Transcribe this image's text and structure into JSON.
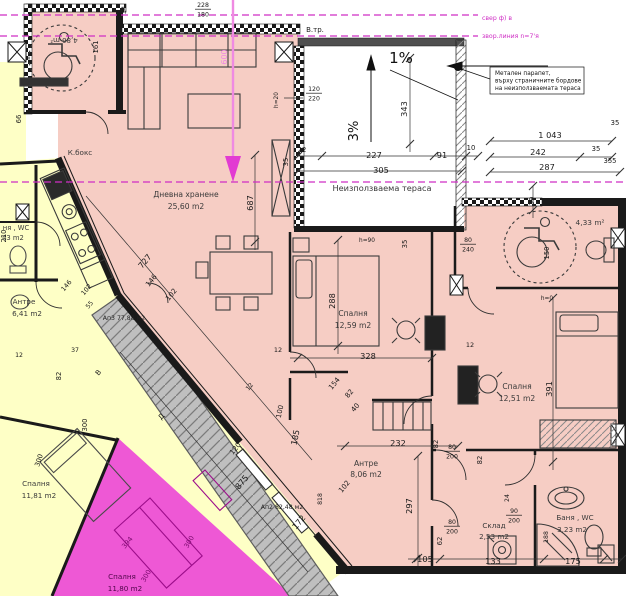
{
  "canvas": {
    "w": 626,
    "h": 596
  },
  "colors": {
    "apartment_fill": "#f6cdc4",
    "neighbor_fill": "#feffc6",
    "magenta_apartment_fill": "#ee58d5",
    "stair_fill": "#bfbfbf",
    "wall": "#1a1a1a",
    "terrace_fill": "#ffffff",
    "annotation_magenta": "#cf2ec4"
  },
  "labels": [
    {
      "n": "room-label-kbox",
      "t": "К.бокс",
      "x": 80,
      "y": 155,
      "s": 7.2,
      "c": "#3a3a3a"
    },
    {
      "n": "room-label-living",
      "t": "Дневна хранене",
      "x": 186,
      "y": 197,
      "s": 7.6,
      "c": "#3a3a3a"
    },
    {
      "n": "room-area-living",
      "t": "25,60 m2",
      "x": 186,
      "y": 209,
      "s": 7.6,
      "c": "#3a3a3a"
    },
    {
      "n": "room-label-terrace",
      "t": "Неизползваема тераса",
      "x": 382,
      "y": 191,
      "s": 8.2,
      "c": "#3a3a3a"
    },
    {
      "n": "room-label-bedroom1",
      "t": "Спалня",
      "x": 353,
      "y": 316,
      "s": 7.6,
      "c": "#3a3a3a"
    },
    {
      "n": "room-area-bedroom1",
      "t": "12,59 m2",
      "x": 353,
      "y": 328,
      "s": 7.6,
      "c": "#3a3a3a"
    },
    {
      "n": "room-label-bedroom2",
      "t": "Спалня",
      "x": 517,
      "y": 389,
      "s": 7.6,
      "c": "#3a3a3a"
    },
    {
      "n": "room-area-bedroom2",
      "t": "12,51 m2",
      "x": 517,
      "y": 401,
      "s": 7.6,
      "c": "#3a3a3a"
    },
    {
      "n": "room-label-hall",
      "t": "Антре",
      "x": 366,
      "y": 466,
      "s": 7.6,
      "c": "#3a3a3a"
    },
    {
      "n": "room-area-hall",
      "t": "8,06 m2",
      "x": 366,
      "y": 477,
      "s": 7.6,
      "c": "#3a3a3a"
    },
    {
      "n": "room-label-storage",
      "t": "Склад",
      "x": 494,
      "y": 528,
      "s": 7.2,
      "c": "#3a3a3a"
    },
    {
      "n": "room-area-storage",
      "t": "2,53 m2",
      "x": 494,
      "y": 539,
      "s": 7.2,
      "c": "#3a3a3a"
    },
    {
      "n": "room-label-bath",
      "t": "Баня , WC",
      "x": 575,
      "y": 520,
      "s": 7.2,
      "c": "#3a3a3a"
    },
    {
      "n": "room-area-bath",
      "t": "3,23 m2",
      "x": 572,
      "y": 532,
      "s": 7.2,
      "c": "#3a3a3a"
    },
    {
      "n": "room-area-bath2",
      "t": "4,33 m²",
      "x": 590,
      "y": 225,
      "s": 7.4,
      "c": "#3a3a3a"
    },
    {
      "n": "room-area-bath1",
      "t": "4,86 m²",
      "x": 64,
      "y": 38,
      "r": 180,
      "s": 7,
      "c": "#3a3a3a"
    },
    {
      "n": "room-label-hall-left",
      "t": "Антре",
      "x": 24,
      "y": 304,
      "s": 7.2,
      "c": "#3a3a3a"
    },
    {
      "n": "room-area-hall-left",
      "t": "6,41 m2",
      "x": 27,
      "y": 316,
      "s": 7.2,
      "c": "#3a3a3a"
    },
    {
      "n": "room-label-wc-left",
      "t": "ня , WC",
      "x": 16,
      "y": 230,
      "s": 6.8,
      "c": "#3a3a3a"
    },
    {
      "n": "room-area-wc-left",
      "t": "43 m2",
      "x": 13,
      "y": 240,
      "s": 6.8,
      "c": "#3a3a3a"
    },
    {
      "n": "room-label-bedroom-left",
      "t": "Спалня",
      "x": 36,
      "y": 486,
      "s": 7.2,
      "c": "#3a3a3a"
    },
    {
      "n": "room-area-bedroom-left",
      "t": "11,81 m2",
      "x": 39,
      "y": 498,
      "s": 7.2,
      "c": "#3a3a3a"
    },
    {
      "n": "room-label-bedroom-magenta",
      "t": "Спалня",
      "x": 122,
      "y": 579,
      "s": 7.2,
      "c": "#50064a"
    },
    {
      "n": "room-area-bedroom-magenta",
      "t": "11,80 m2",
      "x": 125,
      "y": 591,
      "s": 7.2,
      "c": "#50064a"
    },
    {
      "n": "apartment-label-ap3",
      "t": "Ап3 77,88 м2",
      "x": 124,
      "y": 320,
      "s": 6.2,
      "c": "#222222"
    },
    {
      "n": "apartment-label-ap2",
      "t": "Ап2 82,48 м2",
      "x": 282,
      "y": 509,
      "s": 6.2,
      "c": "#222222"
    },
    {
      "n": "label-vtr",
      "t": "В.тр.",
      "x": 315,
      "y": 32,
      "s": 7,
      "c": "#222222"
    },
    {
      "n": "note-line-1",
      "t": "Метален парапет,",
      "x": 495,
      "y": 75,
      "s": 5.8,
      "c": "#111111",
      "a": "start"
    },
    {
      "n": "note-line-2",
      "t": "върху страничните бордове",
      "x": 495,
      "y": 82.5,
      "s": 5.8,
      "c": "#111111",
      "a": "start"
    },
    {
      "n": "note-line-3",
      "t": "на неизползваемата тераса",
      "x": 495,
      "y": 90,
      "s": 5.8,
      "c": "#111111",
      "a": "start"
    },
    {
      "n": "survey-label-1",
      "t": "свер ф) в",
      "x": 482,
      "y": 20,
      "s": 6.2,
      "c": "#cf2ec4",
      "a": "start"
    },
    {
      "n": "survey-label-2",
      "t": "звор.линия n=7'я",
      "x": 482,
      "y": 38,
      "s": 6.2,
      "c": "#cf2ec4",
      "a": "start"
    },
    {
      "n": "dim-600",
      "t": "600",
      "x": 227,
      "y": 57,
      "r": -90,
      "s": 8,
      "c": "#ef8ae2"
    },
    {
      "n": "slope-1pct",
      "t": "1%",
      "x": 401,
      "y": 63,
      "s": 15,
      "c": "#111111"
    },
    {
      "n": "slope-3pct",
      "t": "3%",
      "x": 358,
      "y": 131,
      "r": -90,
      "s": 13,
      "c": "#111111"
    },
    {
      "t": "343",
      "x": 407,
      "y": 109,
      "r": -90,
      "s": 8.2
    },
    {
      "t": "34",
      "x": 126,
      "y": 10,
      "r": -90,
      "s": 6.5
    },
    {
      "t": "22",
      "x": 302,
      "y": 152,
      "s": 6.8
    },
    {
      "t": "227",
      "x": 374,
      "y": 158,
      "s": 8.2
    },
    {
      "t": "91",
      "x": 442,
      "y": 158,
      "s": 8.2
    },
    {
      "t": "10",
      "x": 471,
      "y": 150,
      "s": 6.8
    },
    {
      "t": "305",
      "x": 381,
      "y": 173,
      "s": 8.2
    },
    {
      "t": "35",
      "x": 288,
      "y": 162,
      "r": -90,
      "s": 6.8
    },
    {
      "t": "1 043",
      "x": 550,
      "y": 138,
      "s": 8.2
    },
    {
      "t": "242",
      "x": 538,
      "y": 155,
      "s": 8.2
    },
    {
      "t": "287",
      "x": 547,
      "y": 170,
      "s": 8.2
    },
    {
      "t": "35",
      "x": 596,
      "y": 151,
      "s": 6.8
    },
    {
      "t": "35",
      "x": 615,
      "y": 125,
      "s": 6.8
    },
    {
      "t": "355",
      "x": 610,
      "y": 163,
      "s": 6.8
    },
    {
      "t": "39",
      "x": 534,
      "y": 201,
      "r": -90,
      "s": 6.8
    },
    {
      "t": "150",
      "x": 549,
      "y": 253,
      "r": -90,
      "s": 6.8
    },
    {
      "t": "161",
      "x": 98,
      "y": 47,
      "r": -90,
      "s": 6.8
    },
    {
      "t": "66",
      "x": 21,
      "y": 119,
      "r": -90,
      "s": 6.8
    },
    {
      "t": "210",
      "x": 6,
      "y": 236,
      "r": -90,
      "s": 6.8
    },
    {
      "t": "727",
      "x": 147,
      "y": 263,
      "r": -50,
      "s": 8.2
    },
    {
      "t": "687",
      "x": 253,
      "y": 203,
      "r": -90,
      "s": 8.2
    },
    {
      "t": "h=20",
      "x": 278,
      "y": 100,
      "r": -90,
      "s": 5.8
    },
    {
      "t": "h=90",
      "x": 367,
      "y": 242,
      "s": 5.8
    },
    {
      "t": "35",
      "x": 407,
      "y": 244,
      "r": -90,
      "s": 6.8
    },
    {
      "t": "288",
      "x": 335,
      "y": 301,
      "r": -90,
      "s": 8.2
    },
    {
      "t": "328",
      "x": 368,
      "y": 359,
      "s": 8.2
    },
    {
      "t": "12",
      "x": 278,
      "y": 352,
      "s": 6.5
    },
    {
      "t": "h=0",
      "x": 547,
      "y": 300,
      "s": 5.8
    },
    {
      "t": "12",
      "x": 470,
      "y": 347,
      "s": 6.5
    },
    {
      "t": "391",
      "x": 552,
      "y": 389,
      "r": -90,
      "s": 8.2
    },
    {
      "t": "232",
      "x": 398,
      "y": 446,
      "s": 8.2
    },
    {
      "t": "297",
      "x": 412,
      "y": 506,
      "r": -90,
      "s": 8.2
    },
    {
      "t": "146",
      "x": 153,
      "y": 282,
      "r": -50,
      "s": 7
    },
    {
      "t": "102",
      "x": 173,
      "y": 296,
      "r": -50,
      "s": 7
    },
    {
      "t": "146",
      "x": 68,
      "y": 287,
      "r": -50,
      "s": 6.5
    },
    {
      "t": "102",
      "x": 88,
      "y": 291,
      "r": -50,
      "s": 6.5
    },
    {
      "t": "55",
      "x": 91,
      "y": 306,
      "r": -50,
      "s": 6.2
    },
    {
      "t": "12",
      "x": 19,
      "y": 357,
      "s": 6.2
    },
    {
      "t": "37",
      "x": 75,
      "y": 352,
      "s": 6.2
    },
    {
      "t": "82",
      "x": 61,
      "y": 376,
      "r": -90,
      "s": 6.8
    },
    {
      "t": "300",
      "x": 87,
      "y": 425,
      "r": -90,
      "s": 6.8
    },
    {
      "t": "120",
      "x": 237,
      "y": 450,
      "r": -50,
      "s": 7
    },
    {
      "t": "875",
      "x": 244,
      "y": 484,
      "r": -50,
      "s": 8.2
    },
    {
      "t": "172",
      "x": 301,
      "y": 524,
      "r": -50,
      "s": 8.2
    },
    {
      "t": "818",
      "x": 322,
      "y": 499,
      "r": -90,
      "s": 6.2
    },
    {
      "t": "102",
      "x": 346,
      "y": 488,
      "r": -50,
      "s": 7
    },
    {
      "t": "154",
      "x": 336,
      "y": 385,
      "r": -50,
      "s": 7
    },
    {
      "t": "82",
      "x": 351,
      "y": 395,
      "r": -50,
      "s": 7
    },
    {
      "t": "40",
      "x": 357,
      "y": 409,
      "r": -50,
      "s": 7
    },
    {
      "t": "100",
      "x": 282,
      "y": 412,
      "r": -78,
      "s": 7
    },
    {
      "t": "185",
      "x": 298,
      "y": 438,
      "r": -78,
      "s": 8.2
    },
    {
      "t": "12",
      "x": 251,
      "y": 388,
      "r": -50,
      "s": 6.2
    },
    {
      "t": "24",
      "x": 509,
      "y": 498,
      "r": -90,
      "s": 6.2
    },
    {
      "t": "82",
      "x": 482,
      "y": 460,
      "r": -90,
      "s": 6.8
    },
    {
      "t": "82",
      "x": 438,
      "y": 444,
      "r": -90,
      "s": 6.8
    },
    {
      "t": "62",
      "x": 442,
      "y": 541,
      "r": -90,
      "s": 6.8
    },
    {
      "t": "188",
      "x": 548,
      "y": 537,
      "r": -90,
      "s": 6.2
    },
    {
      "t": "133",
      "x": 493,
      "y": 564,
      "s": 8.2
    },
    {
      "t": "105",
      "x": 425,
      "y": 562,
      "s": 8.2
    },
    {
      "t": "175",
      "x": 573,
      "y": 564,
      "s": 8.2
    },
    {
      "t": "300",
      "x": 41,
      "y": 461,
      "r": -72,
      "s": 6.8
    },
    {
      "t": "394",
      "x": 129,
      "y": 544,
      "r": -50,
      "s": 6.8,
      "c": "#7a0b6e"
    },
    {
      "t": "300",
      "x": 191,
      "y": 543,
      "r": -60,
      "s": 6.8,
      "c": "#7a0b6e"
    },
    {
      "t": "300",
      "x": 148,
      "y": 577,
      "r": -60,
      "s": 6.8,
      "c": "#7a0b6e"
    },
    {
      "n": "section-mark-v",
      "t": "В",
      "x": 100,
      "y": 374,
      "r": -50,
      "s": 7
    },
    {
      "n": "section-mark-d",
      "t": "Д",
      "x": 163,
      "y": 418,
      "r": -50,
      "s": 7
    }
  ],
  "fractions": [
    {
      "n": "dim-fraction",
      "top": "228",
      "bot": "180",
      "x": 203,
      "y": 7
    },
    {
      "n": "door-size",
      "top": "120",
      "bot": "220",
      "x": 314,
      "y": 91
    },
    {
      "n": "door-size",
      "top": "80",
      "bot": "240",
      "x": 468,
      "y": 242
    },
    {
      "n": "door-size",
      "top": "80",
      "bot": "200",
      "x": 452,
      "y": 449
    },
    {
      "n": "door-size",
      "top": "80",
      "bot": "200",
      "x": 452,
      "y": 524
    },
    {
      "n": "door-size",
      "top": "90",
      "bot": "200",
      "x": 514,
      "y": 513
    }
  ]
}
